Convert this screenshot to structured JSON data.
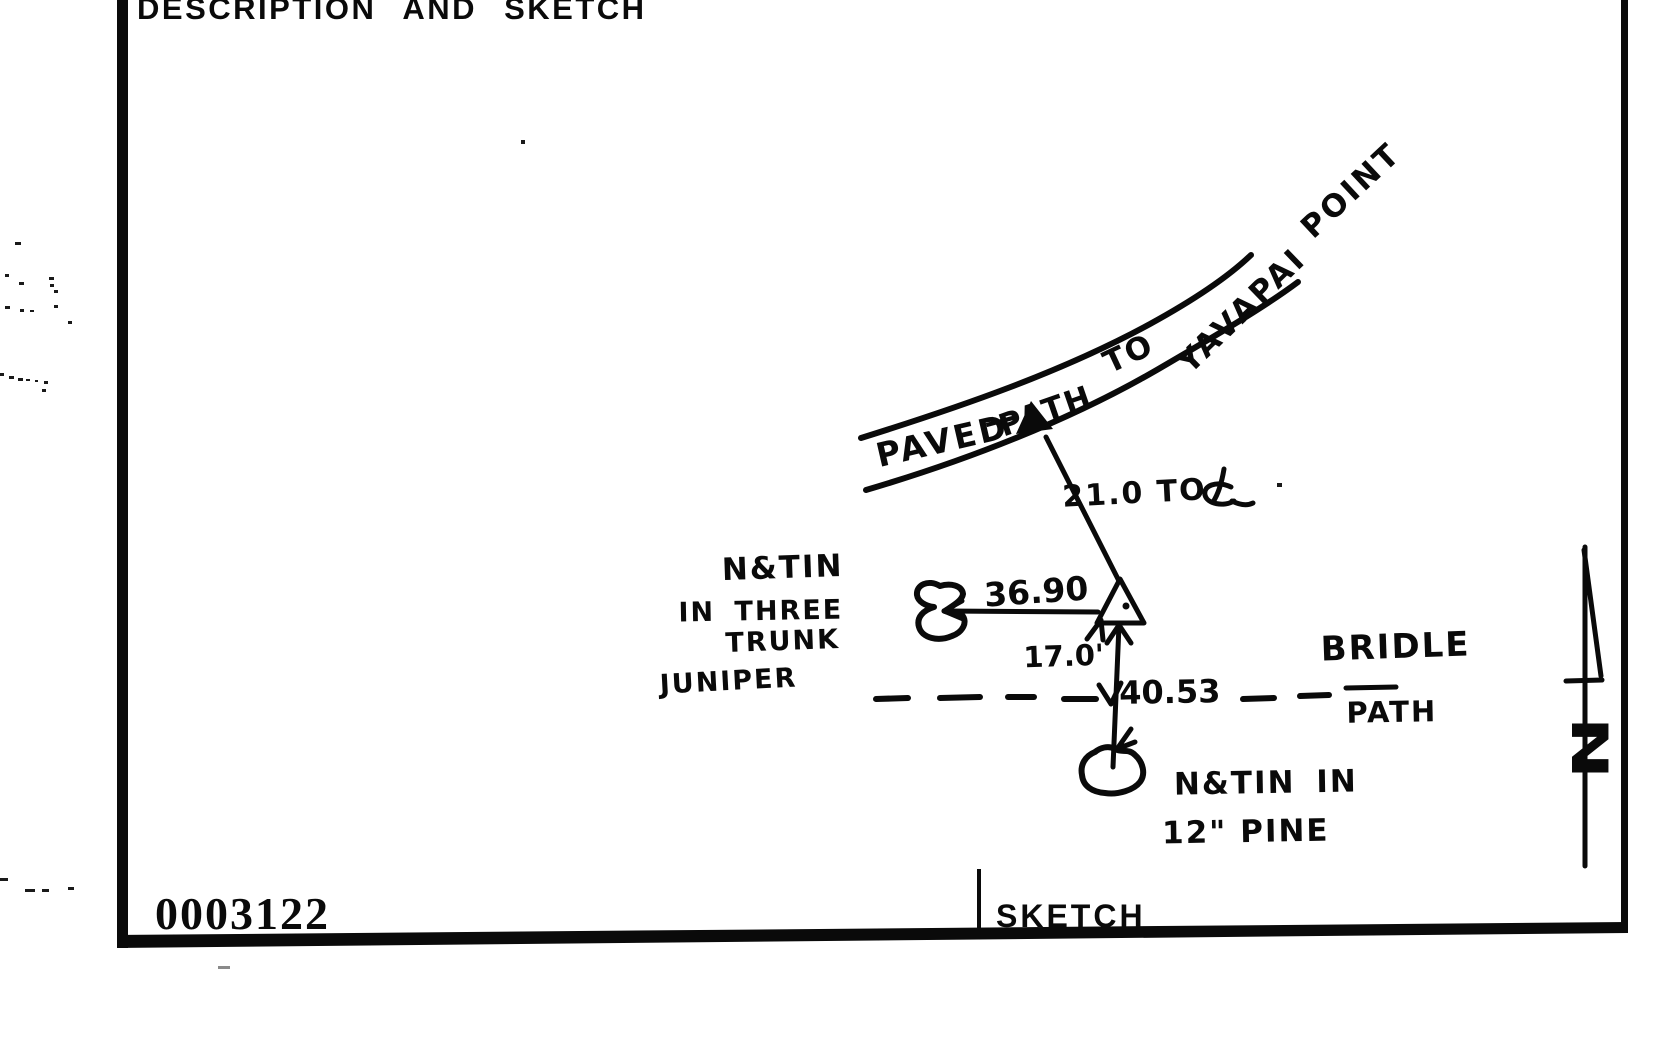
{
  "page": {
    "header": "DESCRIPTION AND SKETCH",
    "stamp_number": "0003122",
    "footer_label": "SKETCH"
  },
  "sketch": {
    "path_label": {
      "paved": "PAVED",
      "dash": "—",
      "path": "PATH",
      "to": "TO",
      "yavapai": "YAVAPAI",
      "point": "POINT"
    },
    "measurements": {
      "to_centerline": "21.0 TO",
      "juniper_distance": "36.90",
      "bridle_offset": "17.0'",
      "pine_distance": "40.53"
    },
    "labels": {
      "juniper_line1": "N&TIN",
      "juniper_line2": "IN THREE",
      "juniper_line3": "TRUNK",
      "juniper_line4": "JUNIPER",
      "bridle": "BRIDLE",
      "bridle_path": "PATH",
      "pine_line1": "N&TIN IN",
      "pine_line2": "12\" PINE",
      "north": "N"
    }
  }
}
